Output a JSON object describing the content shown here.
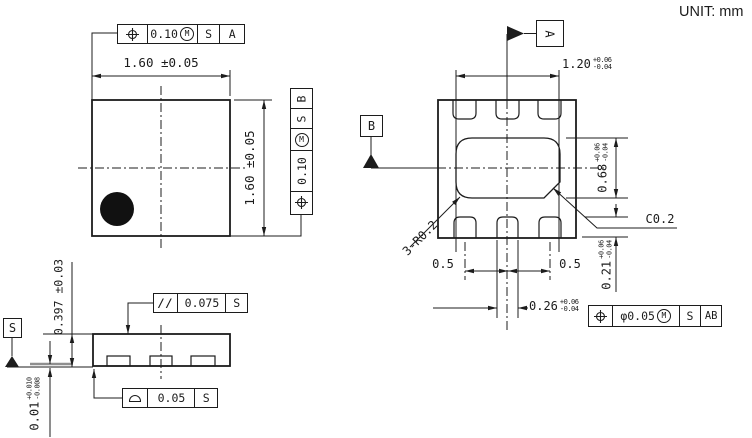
{
  "unit_label": "UNIT: mm",
  "top_view": {
    "width_dim": "1.60 ±0.05",
    "height_dim": "1.60 ±0.05",
    "fcf_datum_a": {
      "tol": "0.10",
      "mod": "M",
      "s": "S",
      "datum": "A"
    },
    "fcf_datum_b": {
      "tol": "0.10",
      "mod": "M",
      "s": "S",
      "datum": "B"
    }
  },
  "bottom_view": {
    "datum_a_label": "A",
    "datum_b_label": "B",
    "pad_span": {
      "v": "1.20",
      "tp": "+0.06",
      "tm": "-0.04"
    },
    "epad_height": {
      "v": "0.68",
      "tp": "+0.06",
      "tm": "-0.04"
    },
    "pad_length": {
      "v": "0.21",
      "tp": "+0.06",
      "tm": "-0.04"
    },
    "pad_width": {
      "v": "0.26",
      "tp": "+0.06",
      "tm": "-0.04"
    },
    "pitch_left": "0.5",
    "pitch_right": "0.5",
    "radius_note": "3-R0.2",
    "chamfer_note": "C0.2",
    "fcf_position": {
      "tol": "φ0.05",
      "mod": "M",
      "s": "S",
      "datum": "AB"
    }
  },
  "side_view": {
    "datum_s_label": "S",
    "height_dim": "0.397 ±0.03",
    "standoff": {
      "v": "0.01",
      "tp": "+0.010",
      "tm": "-0.008"
    },
    "fcf_parallel": {
      "sym": "//",
      "tol": "0.075",
      "datum": "S"
    },
    "fcf_profile": {
      "tol": "0.05",
      "datum": "S"
    }
  }
}
